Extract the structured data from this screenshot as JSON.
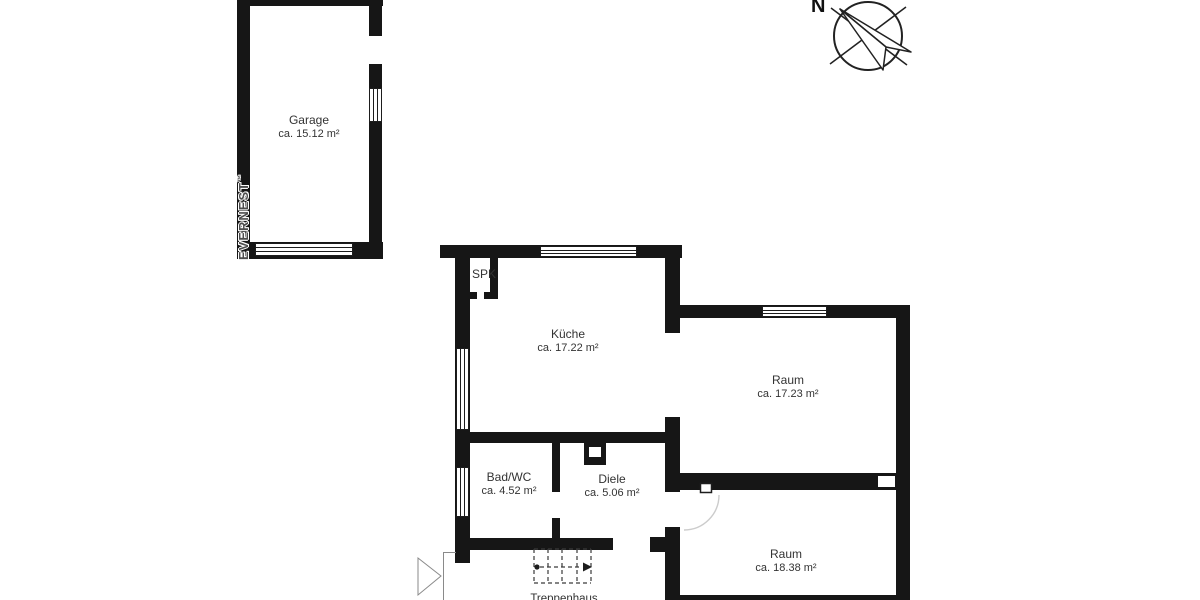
{
  "colors": {
    "bg": "#ffffff",
    "wall": "#161616",
    "line": "#1d1d1d",
    "text": "#333333",
    "arc": "#cccccc",
    "brand": "#4d4d4d"
  },
  "brand": {
    "name": "EVERNEST",
    "trademark": "™"
  },
  "compass": {
    "label": "N"
  },
  "rooms": {
    "garage": {
      "name": "Garage",
      "area": "ca. 15.12 m²"
    },
    "kueche": {
      "name": "Küche",
      "area": "ca. 17.22 m²"
    },
    "raum_top": {
      "name": "Raum",
      "area": "ca. 17.23 m²"
    },
    "raum_bottom": {
      "name": "Raum",
      "area": "ca. 18.38 m²"
    },
    "bad_wc": {
      "name": "Bad/WC",
      "area": "ca. 4.52 m²"
    },
    "diele": {
      "name": "Diele",
      "area": "ca. 5.06 m²"
    },
    "spk": {
      "name": "SPK"
    },
    "treppenhaus": {
      "name": "Treppenhaus"
    }
  }
}
